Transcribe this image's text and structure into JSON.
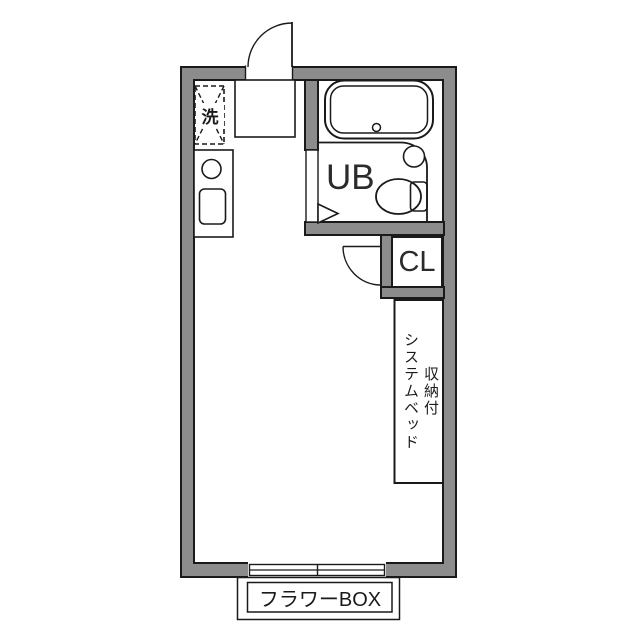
{
  "diagram_type": "apartment-floor-plan",
  "colors": {
    "wall_fill": "#8c8c8c",
    "line": "#1a1a1a",
    "background": "#ffffff",
    "text": "#1a1a1a"
  },
  "labels": {
    "washer_pan": "洗",
    "unit_bath": "UB",
    "closet": "CL",
    "bed_line_1": "収納付",
    "bed_line_2": "システムベッド",
    "flower_box": "フラワーBOX"
  },
  "fixtures": [
    "entrance-swing-door",
    "entrance-step",
    "washer-pan",
    "kitchen-counter",
    "kitchen-burner",
    "kitchen-sink",
    "bathtub",
    "bathtub-drain",
    "corner-wash-basin",
    "toilet",
    "unit-bath-folding-door",
    "closet-swing-door",
    "storage-system-bed",
    "sliding-window",
    "flower-box"
  ]
}
